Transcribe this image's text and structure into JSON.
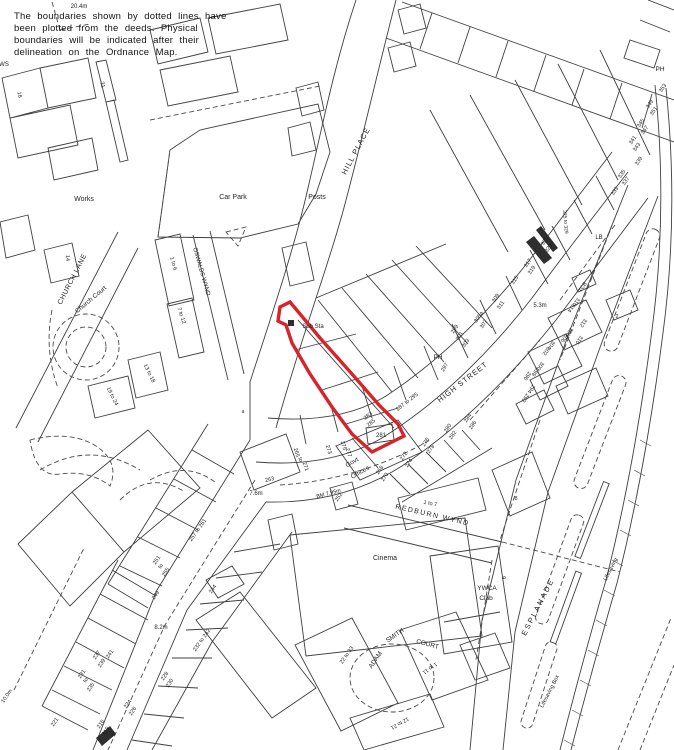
{
  "notice": {
    "line1": "The boundaries shown by dotted lines have",
    "line2": "been plotted from the deeds. Physical",
    "line3": "boundaries will be indicated after their",
    "line4": "delineation on the Ordnance Map."
  },
  "colors": {
    "plot_outline": "#d8232a",
    "map_line": "#3f3f3f",
    "background": "#ffffff"
  },
  "labels": [
    {
      "t": "HILL PLACE",
      "x": 358,
      "y": 152,
      "r": -62,
      "s": 7.5,
      "ls": 1,
      "n": "street-label-hill-place"
    },
    {
      "t": "HIGH STREET",
      "x": 464,
      "y": 384,
      "r": -38,
      "s": 7.5,
      "ls": 1,
      "n": "street-label-high-street"
    },
    {
      "t": "CHURCH LANE",
      "x": 74,
      "y": 280,
      "r": -63,
      "s": 7,
      "ls": 0.5,
      "n": "street-label-church-lane"
    },
    {
      "t": "Church Court",
      "x": 92,
      "y": 301,
      "r": -40,
      "s": 6.5,
      "n": "place-label-church-court"
    },
    {
      "t": "OSWALDS WYND",
      "x": 200,
      "y": 272,
      "r": 74,
      "s": 6,
      "n": "street-label-oswalds-wynd"
    },
    {
      "t": "REDBURN WYND",
      "x": 432,
      "y": 517,
      "r": 13,
      "s": 7,
      "ls": 1.5,
      "n": "street-label-redburn-wynd"
    },
    {
      "t": "ESPLANADE",
      "x": 540,
      "y": 608,
      "r": -63,
      "s": 7.5,
      "ls": 2,
      "n": "street-label-esplanade"
    },
    {
      "t": "ADAM",
      "x": 377,
      "y": 661,
      "r": -55,
      "s": 6.5,
      "n": "street-label-adam-smith-court"
    },
    {
      "t": "SMITH",
      "x": 396,
      "y": 637,
      "r": -35,
      "s": 6.5,
      "n": "street-label-adam-smith-court"
    },
    {
      "t": "COURT",
      "x": 427,
      "y": 646,
      "r": 15,
      "s": 6.5,
      "n": "street-label-adam-smith-court"
    },
    {
      "t": "Works",
      "x": 84,
      "y": 201,
      "s": 7,
      "n": "place-label-works"
    },
    {
      "t": "Car Park",
      "x": 233,
      "y": 199,
      "s": 7,
      "n": "place-label-car-park"
    },
    {
      "t": "Posts",
      "x": 317,
      "y": 199,
      "s": 7,
      "n": "place-label-posts"
    },
    {
      "t": "Cinema",
      "x": 385,
      "y": 560,
      "s": 7,
      "n": "place-label-cinema"
    },
    {
      "t": "YWCA",
      "x": 487,
      "y": 590,
      "s": 6.5,
      "n": "place-label-ywca-club"
    },
    {
      "t": "Club",
      "x": 486,
      "y": 600,
      "s": 6.5,
      "n": "place-label-ywca-club"
    },
    {
      "t": "Govt",
      "x": 353,
      "y": 464,
      "r": -30,
      "s": 6.5,
      "n": "place-label-govt-offices"
    },
    {
      "t": "Offices",
      "x": 361,
      "y": 474,
      "r": -30,
      "s": 6.5,
      "n": "place-label-govt-offices"
    },
    {
      "t": "Sub Sta",
      "x": 313,
      "y": 328,
      "s": 6,
      "n": "place-label-sub-sta"
    },
    {
      "t": "PH",
      "x": 438,
      "y": 359,
      "s": 6.5,
      "n": "place-label-ph"
    },
    {
      "t": "PH",
      "x": 660,
      "y": 71,
      "s": 6.5,
      "n": "place-label-ph"
    },
    {
      "t": "LB",
      "x": 599,
      "y": 239,
      "s": 6,
      "n": "place-label-lb"
    },
    {
      "t": "TCB",
      "x": 584,
      "y": 288,
      "r": -55,
      "s": 5.5,
      "n": "place-label-tcb"
    },
    {
      "t": "Lifesaving Box",
      "x": 551,
      "y": 692,
      "r": -63,
      "s": 5.5,
      "n": "place-label-lifesaving-box"
    },
    {
      "t": "Lifesaving",
      "x": 612,
      "y": 570,
      "r": -63,
      "s": 5.5,
      "n": "place-label-lifesaving-box"
    },
    {
      "t": "20.4m",
      "x": 79,
      "y": 8,
      "s": 6,
      "n": "spot-height"
    },
    {
      "t": "5.3m",
      "x": 540,
      "y": 307,
      "s": 6,
      "n": "spot-height"
    },
    {
      "t": "7.6m",
      "x": 256,
      "y": 495,
      "s": 6,
      "n": "spot-height"
    },
    {
      "t": "8.2m",
      "x": 161,
      "y": 629,
      "s": 6,
      "n": "spot-height"
    },
    {
      "t": "BM 7.95m",
      "x": 329,
      "y": 495,
      "r": -15,
      "s": 5.5,
      "n": "bench-mark"
    },
    {
      "t": "10.0m",
      "x": 8,
      "y": 697,
      "r": -55,
      "s": 5.5,
      "n": "spot-height"
    },
    {
      "t": "297",
      "x": 446,
      "y": 368,
      "r": -60
    },
    {
      "t": "299",
      "x": 456,
      "y": 330,
      "r": -55
    },
    {
      "t": "301",
      "x": 461,
      "y": 337,
      "r": -55
    },
    {
      "t": "303",
      "x": 467,
      "y": 344,
      "r": -55
    },
    {
      "t": "305a",
      "x": 480,
      "y": 318,
      "r": -55
    },
    {
      "t": "307",
      "x": 485,
      "y": 325,
      "r": -55
    },
    {
      "t": "309",
      "x": 497,
      "y": 299,
      "r": -55
    },
    {
      "t": "311",
      "x": 502,
      "y": 306,
      "r": -55
    },
    {
      "t": "315",
      "x": 516,
      "y": 281,
      "r": -55
    },
    {
      "t": "317",
      "x": 529,
      "y": 264,
      "r": -55
    },
    {
      "t": "319",
      "x": 533,
      "y": 271,
      "r": -55
    },
    {
      "t": "321",
      "x": 546,
      "y": 242,
      "r": -55
    },
    {
      "t": "323",
      "x": 550,
      "y": 249,
      "r": -55
    },
    {
      "t": "325 to 329",
      "x": 564,
      "y": 222,
      "r": 85,
      "s": 5
    },
    {
      "t": "333",
      "x": 616,
      "y": 192,
      "r": -55
    },
    {
      "t": "335",
      "x": 623,
      "y": 175,
      "r": -55
    },
    {
      "t": "337",
      "x": 627,
      "y": 182,
      "r": -55
    },
    {
      "t": "339",
      "x": 640,
      "y": 162,
      "r": -55
    },
    {
      "t": "341",
      "x": 634,
      "y": 141,
      "r": -55
    },
    {
      "t": "343",
      "x": 638,
      "y": 148,
      "r": -55
    },
    {
      "t": "345",
      "x": 642,
      "y": 124,
      "r": -55
    },
    {
      "t": "347",
      "x": 646,
      "y": 131,
      "r": -55
    },
    {
      "t": "349",
      "x": 651,
      "y": 105,
      "r": -55
    },
    {
      "t": "351",
      "x": 655,
      "y": 112,
      "r": -55
    },
    {
      "t": "353",
      "x": 664,
      "y": 89,
      "r": -55
    },
    {
      "t": "292",
      "x": 524,
      "y": 397,
      "r": 125
    },
    {
      "t": "294",
      "x": 530,
      "y": 388,
      "r": 125
    },
    {
      "t": "296",
      "x": 526,
      "y": 375,
      "r": 125
    },
    {
      "t": "298",
      "x": 534,
      "y": 371,
      "r": 125
    },
    {
      "t": "300",
      "x": 539,
      "y": 365,
      "r": 125
    },
    {
      "t": "302",
      "x": 545,
      "y": 350,
      "r": 125
    },
    {
      "t": "304",
      "x": 550,
      "y": 344,
      "r": 125
    },
    {
      "t": "306",
      "x": 563,
      "y": 337,
      "r": 125
    },
    {
      "t": "308",
      "x": 568,
      "y": 331,
      "r": 125
    },
    {
      "t": "310",
      "x": 578,
      "y": 339,
      "r": 125
    },
    {
      "t": "312",
      "x": 582,
      "y": 322,
      "r": 125
    },
    {
      "t": "314",
      "x": 570,
      "y": 307,
      "r": 125
    },
    {
      "t": "316",
      "x": 575,
      "y": 301,
      "r": 125
    },
    {
      "t": "2",
      "x": 617,
      "y": 318,
      "s": 5.5
    },
    {
      "t": "283",
      "x": 369,
      "y": 417,
      "r": -38,
      "n": "plot-number"
    },
    {
      "t": "285",
      "x": 372,
      "y": 424,
      "r": -38,
      "n": "plot-number"
    },
    {
      "t": "281",
      "x": 381,
      "y": 437,
      "s": 6,
      "n": "plot-number-281"
    },
    {
      "t": "287 to 295",
      "x": 408,
      "y": 403,
      "r": -38
    },
    {
      "t": "a",
      "x": 243,
      "y": 413,
      "s": 5
    },
    {
      "t": "273",
      "x": 327,
      "y": 450,
      "r": 72
    },
    {
      "t": "275",
      "x": 342,
      "y": 446,
      "r": 72
    },
    {
      "t": "277",
      "x": 347,
      "y": 453,
      "r": 72
    },
    {
      "t": "265",
      "x": 295,
      "y": 453,
      "r": 72
    },
    {
      "t": "to",
      "x": 299,
      "y": 460,
      "r": 72
    },
    {
      "t": "271",
      "x": 304,
      "y": 467,
      "r": 72
    },
    {
      "t": "263",
      "x": 270,
      "y": 481,
      "r": -12
    },
    {
      "t": "268",
      "x": 381,
      "y": 471,
      "r": -55
    },
    {
      "t": "270",
      "x": 386,
      "y": 478,
      "r": -55
    },
    {
      "t": "272",
      "x": 405,
      "y": 457,
      "r": -55
    },
    {
      "t": "274",
      "x": 410,
      "y": 464,
      "r": -55
    },
    {
      "t": "276",
      "x": 427,
      "y": 443,
      "r": -55
    },
    {
      "t": "278",
      "x": 432,
      "y": 450,
      "r": -55
    },
    {
      "t": "280",
      "x": 449,
      "y": 429,
      "r": -55
    },
    {
      "t": "282",
      "x": 454,
      "y": 436,
      "r": -55
    },
    {
      "t": "284",
      "x": 469,
      "y": 419,
      "r": -55
    },
    {
      "t": "286",
      "x": 474,
      "y": 426,
      "r": -55
    },
    {
      "t": "8",
      "x": 516,
      "y": 500,
      "s": 5.5
    },
    {
      "t": "1 to 7",
      "x": 430,
      "y": 505,
      "r": 12,
      "s": 5.5
    },
    {
      "t": "252",
      "x": 340,
      "y": 498,
      "r": -55
    },
    {
      "t": "9",
      "x": 502,
      "y": 578,
      "r": 80,
      "s": 5.5
    },
    {
      "t": "244",
      "x": 214,
      "y": 590,
      "r": -55
    },
    {
      "t": "249",
      "x": 157,
      "y": 596,
      "r": -55
    },
    {
      "t": "251",
      "x": 158,
      "y": 561,
      "r": -55
    },
    {
      "t": "to",
      "x": 162,
      "y": 567,
      "r": -55
    },
    {
      "t": "255",
      "x": 167,
      "y": 573,
      "r": -55
    },
    {
      "t": "257 to 261",
      "x": 199,
      "y": 531,
      "r": -55
    },
    {
      "t": "232 to 242",
      "x": 203,
      "y": 641,
      "r": -55
    },
    {
      "t": "228",
      "x": 166,
      "y": 677,
      "r": -55
    },
    {
      "t": "230",
      "x": 171,
      "y": 684,
      "r": -55
    },
    {
      "t": "224",
      "x": 129,
      "y": 705,
      "r": -55
    },
    {
      "t": "226",
      "x": 134,
      "y": 712,
      "r": -55
    },
    {
      "t": "216",
      "x": 102,
      "y": 725,
      "r": -55
    },
    {
      "t": "218",
      "x": 107,
      "y": 732,
      "r": -55
    },
    {
      "t": "237",
      "x": 98,
      "y": 656,
      "r": -55
    },
    {
      "t": "239",
      "x": 103,
      "y": 664,
      "r": -55
    },
    {
      "t": "241",
      "x": 111,
      "y": 655,
      "r": -55
    },
    {
      "t": "231",
      "x": 83,
      "y": 675,
      "r": -55
    },
    {
      "t": "to",
      "x": 87,
      "y": 681,
      "r": -55
    },
    {
      "t": "235",
      "x": 92,
      "y": 688,
      "r": -55
    },
    {
      "t": "221",
      "x": 56,
      "y": 723,
      "r": -55
    },
    {
      "t": "22 to 33",
      "x": 348,
      "y": 656,
      "r": -55
    },
    {
      "t": "1 to 11",
      "x": 429,
      "y": 667,
      "r": 145
    },
    {
      "t": "12 to 21",
      "x": 399,
      "y": 722,
      "r": 150
    },
    {
      "t": "14",
      "x": 66,
      "y": 258,
      "r": 88
    },
    {
      "t": "16",
      "x": 18,
      "y": 95,
      "r": 80
    },
    {
      "t": "31",
      "x": 101,
      "y": 85,
      "r": 78
    },
    {
      "t": "WS",
      "x": 4,
      "y": 66,
      "s": 6
    },
    {
      "t": "1 to 6",
      "x": 172,
      "y": 264,
      "r": 74
    },
    {
      "t": "7 to 12",
      "x": 180,
      "y": 316,
      "r": 72
    },
    {
      "t": "13 to 18",
      "x": 148,
      "y": 374,
      "r": 64
    },
    {
      "t": "19 to 24",
      "x": 111,
      "y": 397,
      "r": 64
    }
  ]
}
